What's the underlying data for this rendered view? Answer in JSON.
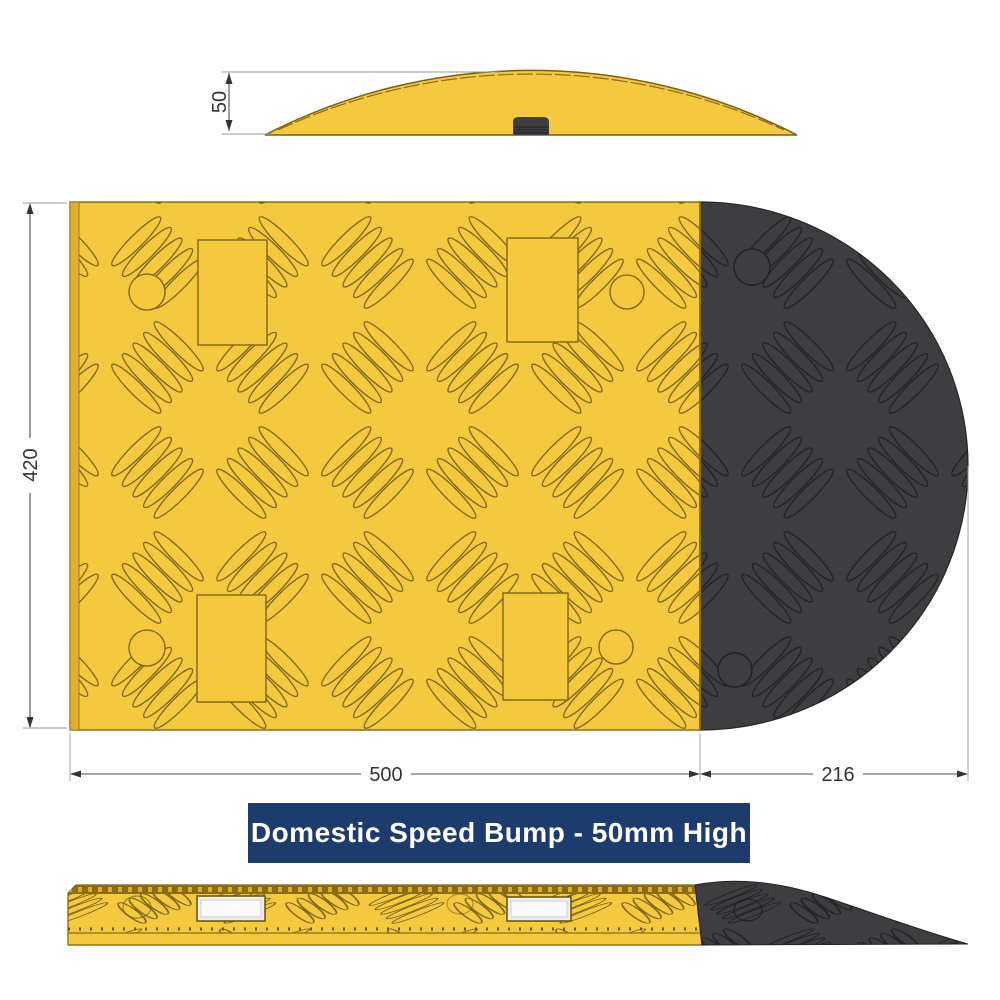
{
  "banner": {
    "label": "Domestic Speed Bump - 50mm High",
    "bg": "#1E3B6D",
    "fg": "#FFFFFF"
  },
  "dimensions": {
    "profile_height": "50",
    "plan_depth": "420",
    "plan_body_length": "500",
    "plan_cap_length": "216"
  },
  "colors": {
    "body_yellow": "#F5C93E",
    "yellow_edge": "#E2B02E",
    "tread_stroke": "#6B560F",
    "cap_black": "#3E3E41",
    "cap_tread_stroke": "#232326",
    "reflective_strip": "#EDEDEF",
    "dimension_line": "#4A4A4A",
    "background": "#FFFFFF"
  }
}
